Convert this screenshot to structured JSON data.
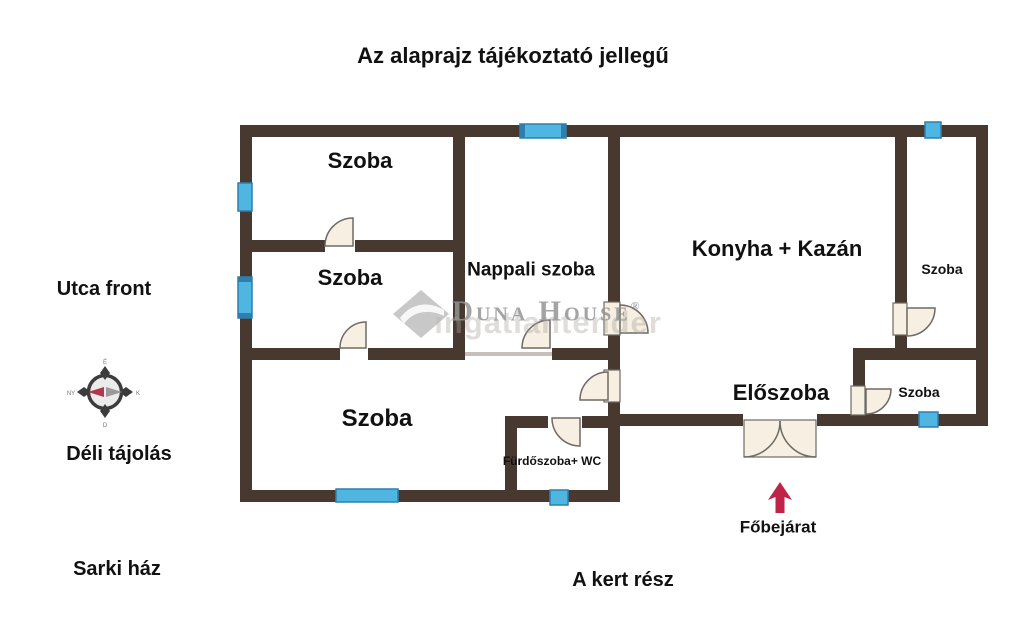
{
  "title": "Az alaprajz tájékoztató jellegű",
  "side_labels": {
    "utca_front": "Utca front",
    "deli_tajolas": "Déli tájolás",
    "sarki_haz": "Sarki ház",
    "kert_resz": "A kert rész"
  },
  "entrance": {
    "label": "Főbejárat"
  },
  "rooms": {
    "szoba_top_left": "Szoba",
    "szoba_mid_left": "Szoba",
    "szoba_bottom_left": "Szoba",
    "nappali": "Nappali szoba",
    "konyha": "Konyha + Kazán",
    "szoba_right_tall": "Szoba",
    "eloszoba": "Előszoba",
    "szoba_right_small": "Szoba",
    "furdoszoba": "Fürdőszoba+ WC"
  },
  "watermark": {
    "brand": "Duna House",
    "registered": "®",
    "sub": "ingatlantender"
  },
  "compass": {
    "n": "É",
    "e": "K",
    "s": "D",
    "w": "NY"
  },
  "colors": {
    "wall": "#473930",
    "window": "#4fb6e2",
    "window_edge": "#2e7fae",
    "door_fill": "#f6efe2",
    "door_stroke": "#6e6a64",
    "arrow": "#bf2347",
    "text": "#111111"
  }
}
